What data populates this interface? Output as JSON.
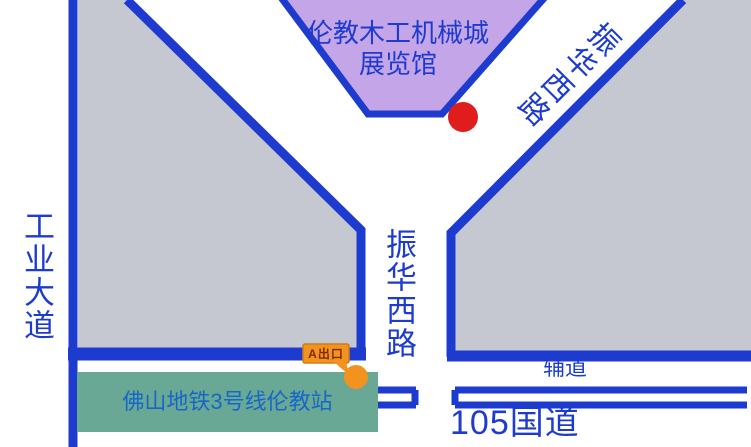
{
  "colors": {
    "background": "#ffffff",
    "road_blue": "#1e3bcf",
    "block_gray": "#c5c7d1",
    "building_purple": "#c4a5e7",
    "station_green": "#68a894",
    "marker_red": "#df1d1d",
    "exit_orange": "#f29320",
    "exit_orange_border": "#cf7d14",
    "station_text_blue": "#1767c9",
    "exit_text_brown": "#7c2a00"
  },
  "building": {
    "label_line1": "伦教木工机械城",
    "label_line2": "展览馆"
  },
  "roads": {
    "industrial_avenue": "工业大道",
    "zhenhua_west_diagonal": "振华西路",
    "zhenhua_west_stem": "振华西路",
    "national_highway": "105国道",
    "frontage_road": "辅道"
  },
  "station": {
    "label": "佛山地铁3号线伦教站",
    "exit_label": "A出口"
  }
}
